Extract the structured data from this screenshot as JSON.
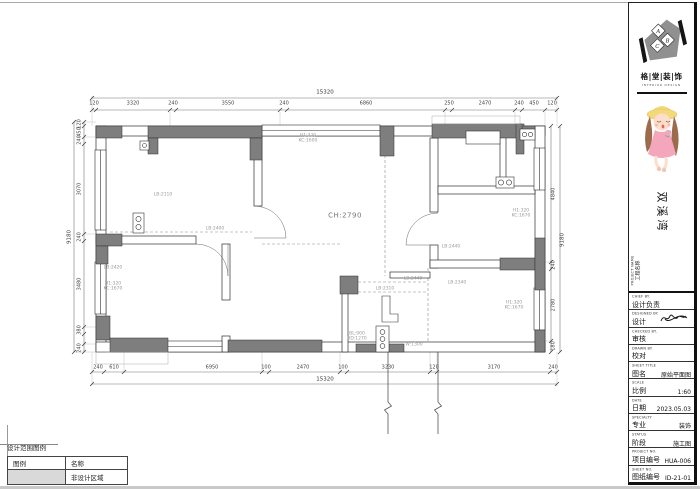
{
  "title_block": {
    "logo_letters": [
      "A",
      "B",
      "C"
    ],
    "brand_cn": "格|堂|装|饰",
    "brand_en": "INTERIOR DESIGN",
    "project_name": "双溪湾",
    "project_label_en": "PROJECT NAME",
    "project_label_zh": "工程名称",
    "fields": [
      {
        "en": "CHIEF BY.",
        "zh": "设计负责",
        "value": ""
      },
      {
        "en": "DESIGNED BY.",
        "zh": "设计",
        "value": "",
        "signature": true
      },
      {
        "en": "CHECKED BY.",
        "zh": "审核",
        "value": ""
      },
      {
        "en": "DRAWN BY.",
        "zh": "校对",
        "value": ""
      },
      {
        "en": "SHEET TITLE",
        "zh": "图名",
        "value": "原始平面图"
      },
      {
        "en": "SCALE",
        "zh": "比例",
        "value": "1:60"
      },
      {
        "en": "DATE",
        "zh": "日期",
        "value": "2023.05.03"
      },
      {
        "en": "SPECIALTY",
        "zh": "专业",
        "value": "装饰"
      },
      {
        "en": "STATUS",
        "zh": "阶段",
        "value": "施工图"
      },
      {
        "en": "PROJECT NO.",
        "zh": "项目编号",
        "value": "HUA-006"
      },
      {
        "en": "SHEET NO.",
        "zh": "图纸编号",
        "value": "ID-21-01"
      }
    ]
  },
  "legend": {
    "title": "设计范围图例",
    "headers": [
      "图例",
      "名称"
    ],
    "rows": [
      {
        "swatch": "#d9d9d9",
        "name": "非设计区域"
      }
    ]
  },
  "floorplan": {
    "ceiling_label": {
      "t": "CH:2790",
      "x": 345,
      "y": 216
    },
    "overall_dims": [
      {
        "t": "15320",
        "x": 325,
        "y": 93
      },
      {
        "t": "15320",
        "x": 325,
        "y": 380
      },
      {
        "t": "9180",
        "x": 70,
        "y": 237,
        "r": -90
      },
      {
        "t": "9180",
        "x": 563,
        "y": 240,
        "r": -90
      }
    ],
    "dim_rows": [
      {
        "axis": "h",
        "y": 104,
        "items": [
          {
            "t": "120",
            "x": 94
          },
          {
            "t": "3320",
            "x": 133
          },
          {
            "t": "240",
            "x": 173
          },
          {
            "t": "3550",
            "x": 228
          },
          {
            "t": "240",
            "x": 284
          },
          {
            "t": "6860",
            "x": 366
          },
          {
            "t": "250",
            "x": 449
          },
          {
            "t": "2470",
            "x": 485
          },
          {
            "t": "240",
            "x": 519
          },
          {
            "t": "450",
            "x": 534
          },
          {
            "t": "120",
            "x": 552
          }
        ]
      },
      {
        "axis": "h",
        "y": 368,
        "items": [
          {
            "t": "240",
            "x": 98
          },
          {
            "t": "610",
            "x": 114
          },
          {
            "t": "6950",
            "x": 212
          },
          {
            "t": "100",
            "x": 266
          },
          {
            "t": "2470",
            "x": 303
          },
          {
            "t": "100",
            "x": 343
          },
          {
            "t": "3230",
            "x": 388
          },
          {
            "t": "120",
            "x": 434
          },
          {
            "t": "3170",
            "x": 494
          },
          {
            "t": "240",
            "x": 553
          }
        ]
      },
      {
        "axis": "v",
        "x": 80,
        "items": [
          {
            "t": "120",
            "y": 124
          },
          {
            "t": "450",
            "y": 132
          },
          {
            "t": "240",
            "y": 140
          },
          {
            "t": "3070",
            "y": 189
          },
          {
            "t": "240",
            "y": 237
          },
          {
            "t": "3480",
            "y": 284
          },
          {
            "t": "380",
            "y": 330
          },
          {
            "t": "240",
            "y": 348
          }
        ]
      },
      {
        "axis": "v",
        "x": 554,
        "items": [
          {
            "t": "4840",
            "y": 194
          },
          {
            "t": "240",
            "y": 265
          },
          {
            "t": "2780",
            "y": 305
          },
          {
            "t": "180",
            "y": 346
          }
        ]
      }
    ],
    "annotations": [
      {
        "t": "LB:2110",
        "x": 163,
        "y": 195
      },
      {
        "t": "LB:2400",
        "x": 215,
        "y": 229
      },
      {
        "t": "H1:320",
        "x": 308,
        "y": 136
      },
      {
        "t": "KC:1600",
        "x": 308,
        "y": 141
      },
      {
        "t": "LB:2420",
        "x": 113,
        "y": 268
      },
      {
        "t": "H1:320",
        "x": 113,
        "y": 284
      },
      {
        "t": "KC:1670",
        "x": 113,
        "y": 289
      },
      {
        "t": "H1:320",
        "x": 521,
        "y": 211
      },
      {
        "t": "KC:1670",
        "x": 521,
        "y": 216
      },
      {
        "t": "H1:320",
        "x": 514,
        "y": 303
      },
      {
        "t": "KC:1670",
        "x": 514,
        "y": 308
      },
      {
        "t": "LB:2440",
        "x": 413,
        "y": 279
      },
      {
        "t": "LB:2310",
        "x": 385,
        "y": 289
      },
      {
        "t": "LB:2340",
        "x": 457,
        "y": 283
      },
      {
        "t": "LB:2440",
        "x": 451,
        "y": 247
      },
      {
        "t": "W:1300",
        "x": 414,
        "y": 345
      },
      {
        "t": "BL:900",
        "x": 357,
        "y": 334
      },
      {
        "t": "BD:1270",
        "x": 357,
        "y": 339
      }
    ]
  }
}
